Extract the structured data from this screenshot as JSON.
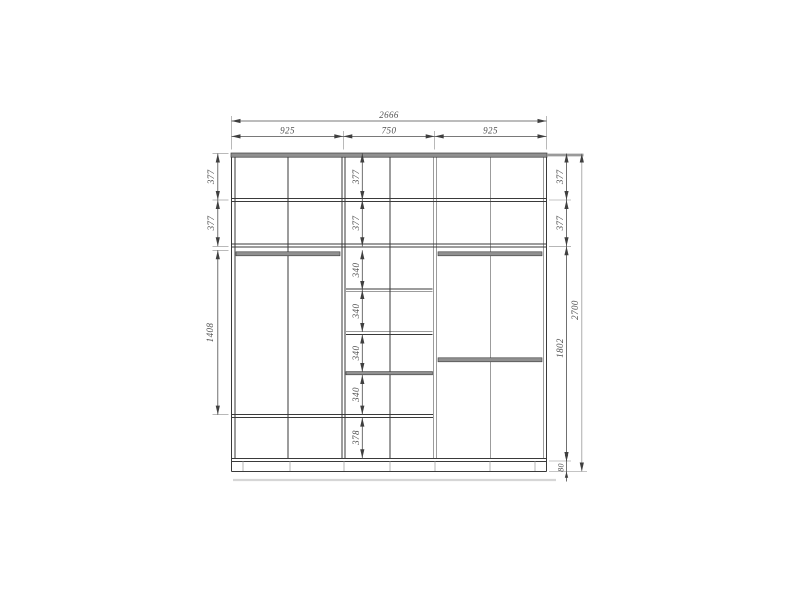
{
  "drawing": {
    "colors": {
      "panel_gray": "#909090",
      "structure_line": "#3a3a3a",
      "dimension_line": "#4d4d4d",
      "dimension_text": "#4f4f4f"
    },
    "dims": {
      "total_width": "2666",
      "widths": [
        "925",
        "750",
        "925"
      ],
      "left": [
        "377",
        "377",
        "1408"
      ],
      "middle": [
        "377",
        "377",
        "340",
        "340",
        "340",
        "340",
        "378"
      ],
      "right": [
        "377",
        "377",
        "1802",
        "80"
      ],
      "total_height": "2700"
    }
  }
}
